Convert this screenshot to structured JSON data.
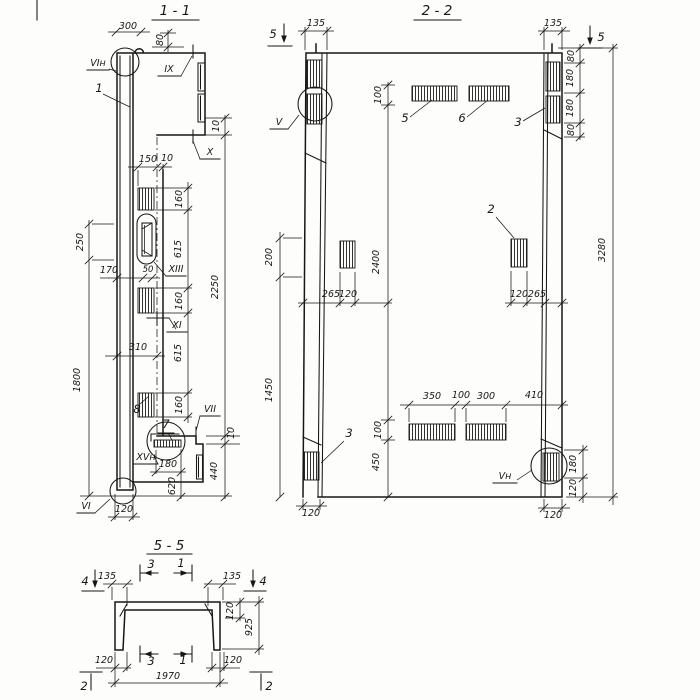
{
  "drawing": {
    "s11": {
      "title": "1 - 1",
      "d300": "300",
      "d80": "80",
      "d150": "150",
      "d10": "10",
      "d160": "160",
      "d615": "615",
      "d2250": "2250",
      "d250": "250",
      "d170": "170",
      "d50": "50",
      "d310": "310",
      "d1800": "1800",
      "d180": "180",
      "d620": "620",
      "d440": "440",
      "d120": "120",
      "lbl1": "1",
      "lbl7": "7",
      "lbl8": "8",
      "m_vin": "VIн",
      "m_ix": "IX",
      "m_x": "X",
      "m_xi": "XI",
      "m_xiii": "XIII",
      "m_vii": "VII",
      "m_xvn": "XVн",
      "m_vi": "VI"
    },
    "s22": {
      "title": "2 - 2",
      "cut5": "5",
      "d135": "135",
      "d80": "80",
      "d180": "180",
      "d100": "100",
      "d200": "200",
      "d2400": "2400",
      "d3280": "3280",
      "d265": "265",
      "d120": "120",
      "d1450": "1450",
      "d450": "450",
      "d350": "350",
      "d300": "300",
      "d410": "410",
      "lbl5": "5",
      "lbl6": "6",
      "lbl3": "3",
      "lbl2": "2",
      "m_v": "V",
      "m_vn": "Vн"
    },
    "s55": {
      "title": "5 - 5",
      "cut1": "1",
      "cut2": "2",
      "cut3": "3",
      "cut4": "4",
      "d135": "135",
      "d120": "120",
      "d925": "925",
      "d1970": "1970"
    }
  }
}
